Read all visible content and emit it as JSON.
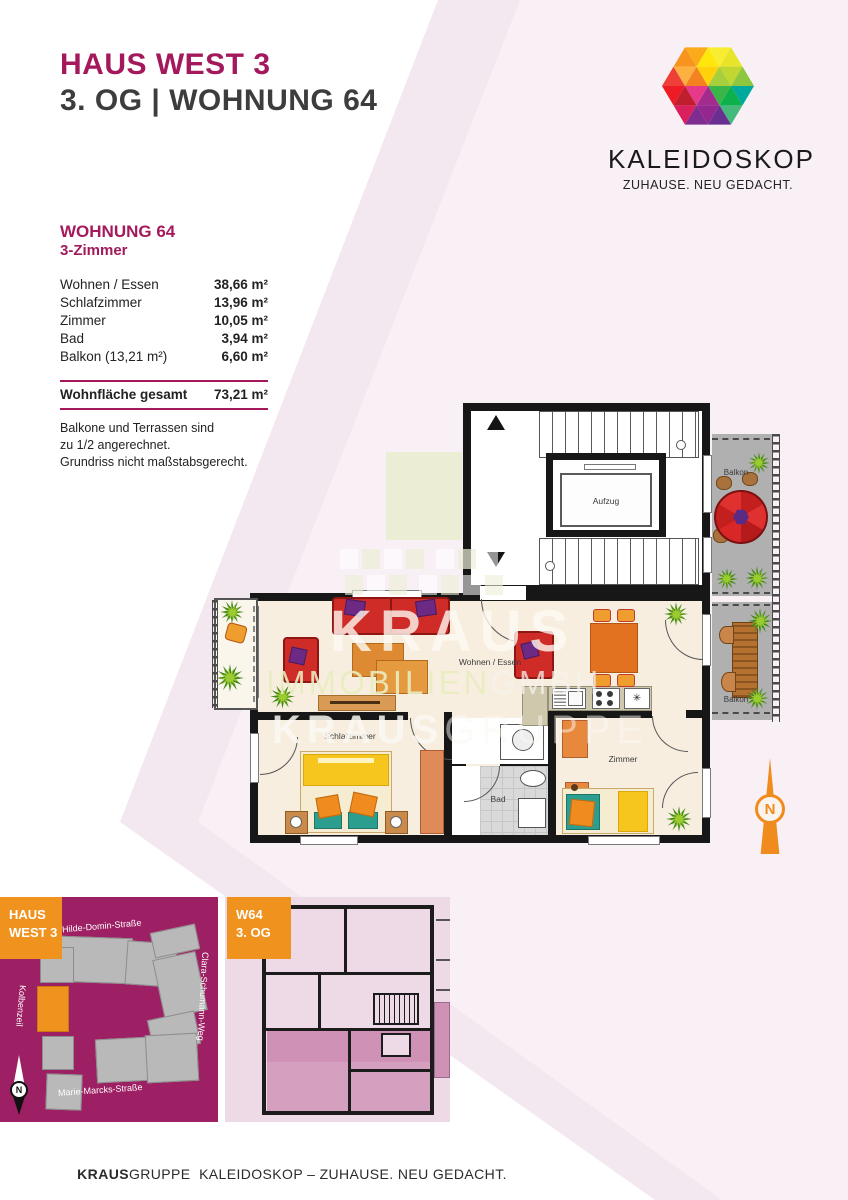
{
  "header": {
    "title": "HAUS WEST 3",
    "subtitle": "3. OG | WOHNUNG 64"
  },
  "brand": {
    "name": "KALEIDOSKOP",
    "tagline": "ZUHAUSE. NEU GEDACHT."
  },
  "areas": {
    "heading": "WOHNUNG 64",
    "subheading": "3-Zimmer",
    "rows": [
      {
        "label": "Wohnen / Essen",
        "value": "38,66 m²"
      },
      {
        "label": "Schlafzimmer",
        "value": "13,96 m²"
      },
      {
        "label": "Zimmer",
        "value": "10,05 m²"
      },
      {
        "label": "Bad",
        "value": "3,94 m²"
      },
      {
        "label": "Balkon (13,21 m²)",
        "value": "6,60 m²"
      }
    ],
    "total_label": "Wohnfläche gesamt",
    "total_value": "73,21 m²",
    "notes": [
      "Balkone und Terrassen sind",
      "zu 1/2 angerechnet.",
      "Grundriss nicht maßstabsgerecht."
    ]
  },
  "floorplan": {
    "living": "Wohnen / Essen",
    "bedroom": "Schlafzimmer",
    "room": "Zimmer",
    "bath": "Bad",
    "elevator": "Aufzug",
    "balcony_top": "Balkon",
    "balcony_bottom": "Balkon",
    "appliance": "✳",
    "north": "N"
  },
  "watermark": {
    "kraus": "KRAUS",
    "immobilien": "IMMOBILIEN",
    "gmbh": "GMBH",
    "kraus2": "KRAUS",
    "gruppe": "GRUPPE"
  },
  "site_map": {
    "label1": "HAUS",
    "label2": "WEST 3",
    "street_top": "Hilde-Domin-Straße",
    "street_right": "Clara-Schumann-Weg",
    "street_left": "Kolbenzeil",
    "street_bottom": "Marie-Marcks-Straße",
    "north": "N"
  },
  "unit_map": {
    "label1": "W64",
    "label2": "3. OG"
  },
  "footer": {
    "strong": "KRAUS",
    "rest": "GRUPPE",
    "text": "  KALEIDOSKOP – ZUHAUSE. NEU GEDACHT."
  },
  "colors": {
    "magenta": "#a3195b",
    "orange": "#f0921e",
    "map_magenta": "#9e2064",
    "plan_floor": "#f8eee0",
    "balcony_gray": "#b0b0b0"
  }
}
